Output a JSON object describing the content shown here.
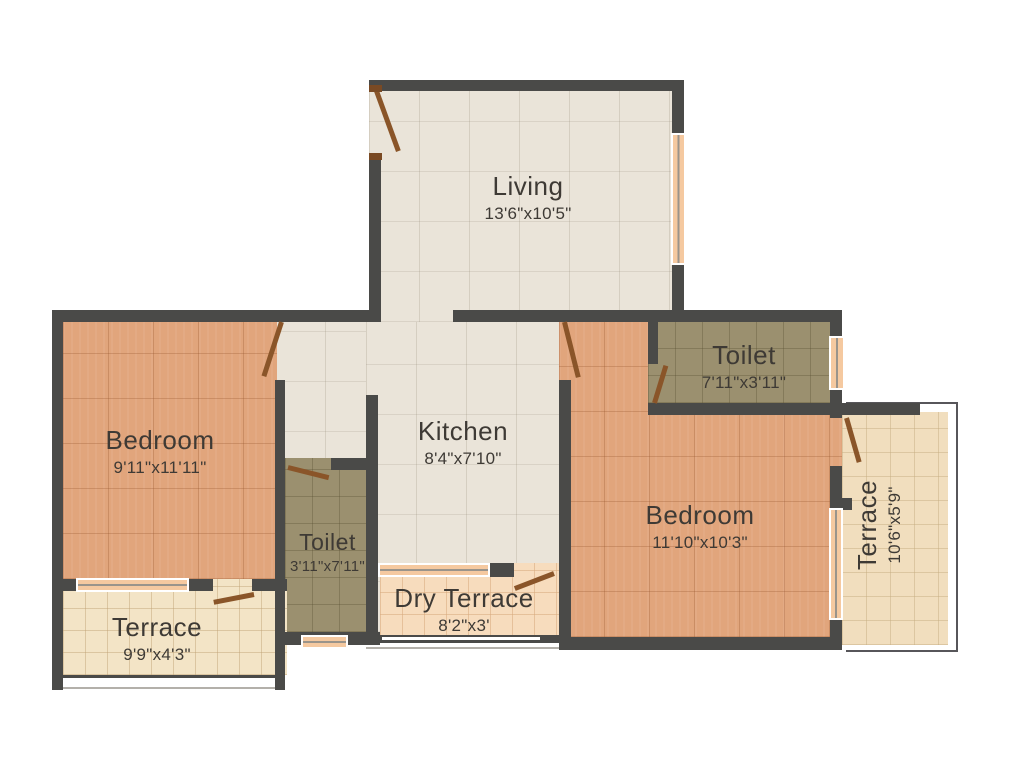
{
  "rooms": {
    "living": {
      "name": "Living",
      "dims": "13'6\"x10'5\""
    },
    "kitchen": {
      "name": "Kitchen",
      "dims": "8'4\"x7'10\""
    },
    "bedroom_left": {
      "name": "Bedroom",
      "dims": "9'11\"x11'11\""
    },
    "bedroom_right": {
      "name": "Bedroom",
      "dims": "11'10\"x10'3\""
    },
    "toilet_center": {
      "name": "Toilet",
      "dims": "3'11\"x7'11\""
    },
    "toilet_right": {
      "name": "Toilet",
      "dims": "7'11\"x3'11\""
    },
    "dry_terrace": {
      "name": "Dry Terrace",
      "dims": "8'2\"x3'"
    },
    "terrace_left": {
      "name": "Terrace",
      "dims": "9'9\"x4'3\""
    },
    "terrace_right": {
      "name": "Terrace",
      "dims": "10'6\"x5'9\""
    }
  },
  "colors": {
    "wall": "#4a4a48",
    "floor_living_kitchen": "#eae4d9",
    "floor_bedroom": "#e1a57c",
    "floor_toilet": "#9b906f",
    "floor_terrace": "#f3e4c6",
    "floor_dry_terrace": "#f7dcbd",
    "window_pane": "#f5c9a0",
    "door_leaf": "#8a5529",
    "label_text": "#3e3a35",
    "background": "#ffffff"
  }
}
